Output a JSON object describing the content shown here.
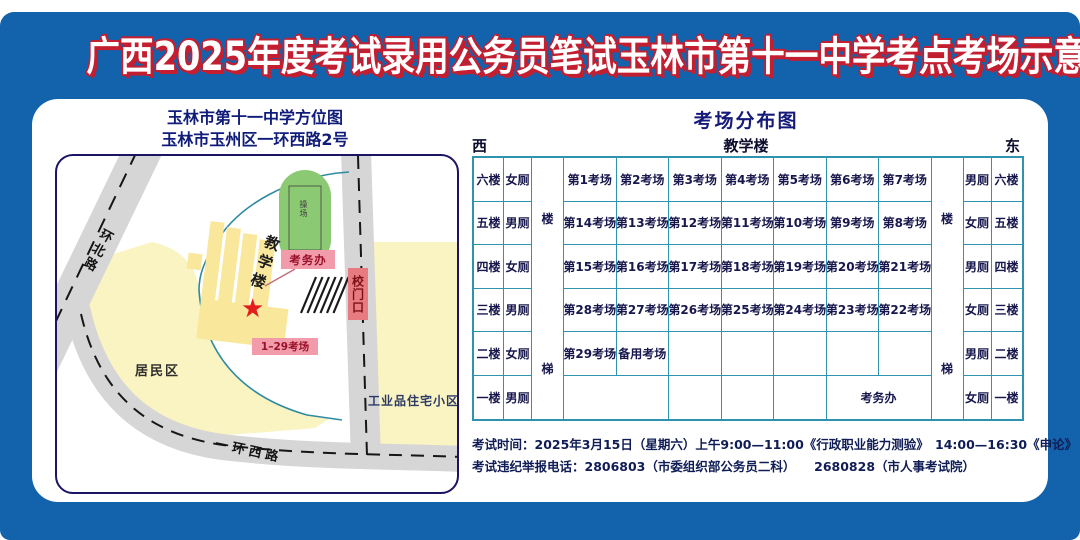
{
  "header": {
    "title": "广西2025年度考试录用公务员笔试玉林市第十一中学考点考场示意图"
  },
  "map_panel": {
    "title_line1": "玉林市第十一中学方位图",
    "title_line2": "玉林市玉州区一环西路2号",
    "labels": {
      "road_north": "环北路",
      "road_west": "一环西路",
      "playground": "操场",
      "teaching_building": "教学楼",
      "exam_office": "考务办",
      "school_gate": "校门口",
      "rooms_range": "1–29考场",
      "residential_area": "居民区",
      "industrial_community": "工业品住宅小区",
      "star_marker": "★"
    }
  },
  "distribution": {
    "title": "考场分布图",
    "west": "西",
    "building": "教学楼",
    "east": "东",
    "stairs": {
      "top": "楼",
      "bottom": "梯"
    },
    "rows": [
      {
        "floor_left": "六楼",
        "toilet_left": "女厕",
        "cells": [
          {
            "text": "第1考场"
          },
          {
            "text": "第2考场"
          },
          {
            "text": "第3考场"
          },
          {
            "text": "第4考场"
          },
          {
            "text": "第5考场"
          },
          {
            "text": "第6考场"
          },
          {
            "text": "第7考场"
          }
        ],
        "toilet_right": "男厕",
        "floor_right": "六楼"
      },
      {
        "floor_left": "五楼",
        "toilet_left": "男厕",
        "cells": [
          {
            "text": "第14考场"
          },
          {
            "text": "第13考场"
          },
          {
            "text": "第12考场"
          },
          {
            "text": "第11考场"
          },
          {
            "text": "第10考场"
          },
          {
            "text": "第9考场"
          },
          {
            "text": "第8考场"
          }
        ],
        "toilet_right": "女厕",
        "floor_right": "五楼"
      },
      {
        "floor_left": "四楼",
        "toilet_left": "女厕",
        "cells": [
          {
            "text": "第15考场"
          },
          {
            "text": "第16考场"
          },
          {
            "text": "第17考场"
          },
          {
            "text": "第18考场"
          },
          {
            "text": "第19考场"
          },
          {
            "text": "第20考场"
          },
          {
            "text": "第21考场"
          }
        ],
        "toilet_right": "男厕",
        "floor_right": "四楼"
      },
      {
        "floor_left": "三楼",
        "toilet_left": "男厕",
        "cells": [
          {
            "text": "第28考场"
          },
          {
            "text": "第27考场"
          },
          {
            "text": "第26考场"
          },
          {
            "text": "第25考场"
          },
          {
            "text": "第24考场"
          },
          {
            "text": "第23考场"
          },
          {
            "text": "第22考场"
          }
        ],
        "toilet_right": "女厕",
        "floor_right": "三楼"
      },
      {
        "floor_left": "二楼",
        "toilet_left": "女厕",
        "cells": [
          {
            "text": "第29考场"
          },
          {
            "text": "备用考场"
          },
          {
            "text": ""
          },
          {
            "text": ""
          },
          {
            "text": ""
          },
          {
            "text": ""
          },
          {
            "text": ""
          }
        ],
        "toilet_right": "男厕",
        "floor_right": "二楼"
      },
      {
        "floor_left": "一楼",
        "toilet_left": "男厕",
        "cells": [
          {
            "text": "",
            "span": 2
          },
          {
            "text": ""
          },
          {
            "text": ""
          },
          {
            "text": ""
          },
          {
            "text": "考务办",
            "span": 2
          }
        ],
        "toilet_right": "女厕",
        "floor_right": "一楼"
      }
    ]
  },
  "footer": {
    "line1": "考试时间：2025年3月15日（星期六）上午9:00—11:00《行政职业能力测验》　14:00—16:30《申论》",
    "line2": "考试违纪举报电话：2806803（市委组织部公务员二科）　　2680828（市人事考试院）"
  },
  "colors": {
    "frame_blue": "#1262ac",
    "title_fill": "#ffffff",
    "title_outline_red": "#c31f30",
    "heading_navy": "#101c7a",
    "table_border_teal": "#2f93b0",
    "table_text_navy": "#17174d",
    "road_gray": "#d6d6d6",
    "area_yellow": "#faf3c2",
    "building_yellow": "#f9e79c",
    "field_green": "#8cc973",
    "label_pink": "#f29cab",
    "label_dark_red": "#99102a",
    "gate_pink": "#e87a82",
    "star_red": "#e51c1c",
    "map_border_navy": "#1b1464"
  }
}
